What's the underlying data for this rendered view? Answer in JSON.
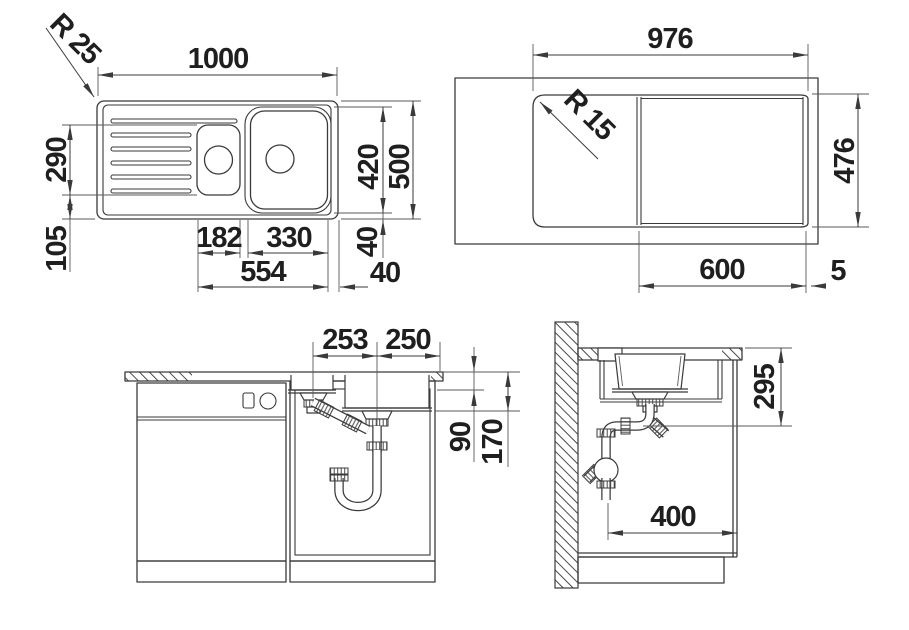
{
  "drawing": {
    "top_view": {
      "radius_label": "R 25",
      "overall_width": "1000",
      "bowl_length": "290",
      "bottom_offset": "105",
      "small_bowl_width": "182",
      "main_bowl_width": "330",
      "bowls_span": "554",
      "right_gap": "40",
      "bowl_zone_height": "420",
      "overall_depth": "500",
      "bottom_gap": "40"
    },
    "cutout_view": {
      "cutout_width": "976",
      "radius_label": "R 15",
      "cutout_depth": "476",
      "bowl_zone_width": "600",
      "edge_lip": "5"
    },
    "front_view": {
      "small_bowl_drain_offset": "253",
      "main_bowl_drain_offset": "250",
      "small_bowl_depth": "90",
      "main_bowl_depth": "170"
    },
    "side_view": {
      "drain_height": "295",
      "trap_wall_offset": "400"
    }
  },
  "colors": {
    "line": "#3a3a3a",
    "text": "#1f1f1f",
    "background": "#ffffff"
  }
}
